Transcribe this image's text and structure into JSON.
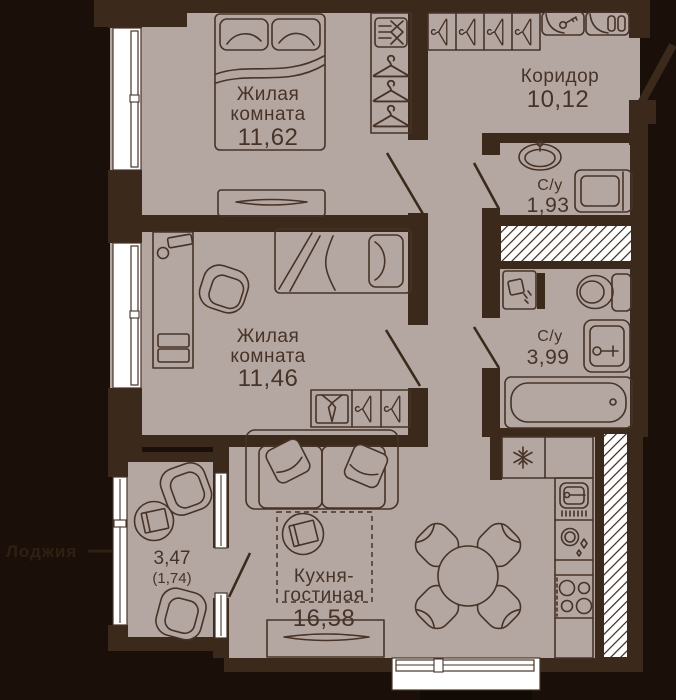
{
  "title": "Apartment floor plan",
  "colors": {
    "background": "#1a1009",
    "wall": "#3b2a1c",
    "floor": "#b4a7a2",
    "outline": "#473327",
    "text": "#473327",
    "window_white": "#ffffff",
    "outside_label": "#2f2013"
  },
  "rooms": {
    "room1": {
      "name_line1": "Жилая",
      "name_line2": "комната",
      "area": "11,62"
    },
    "room2": {
      "name_line1": "Жилая",
      "name_line2": "комната",
      "area": "11,46"
    },
    "corridor": {
      "name": "Коридор",
      "area": "10,12"
    },
    "bathroom1": {
      "name": "С/у",
      "area": "1,93"
    },
    "bathroom2": {
      "name": "С/у",
      "area": "3,99"
    },
    "kitchen_living": {
      "name_line1": "Кухня-",
      "name_line2": "гостиная",
      "area": "16,58"
    },
    "loggia": {
      "area": "3,47",
      "area_coeff": "(1,74)",
      "callout": "Лоджия"
    }
  },
  "icons": [
    "double-bed-icon",
    "pillow-icon",
    "wardrobe-hanger-icon",
    "clothes-box-icon",
    "dresser-icon",
    "desk-icon",
    "office-chair-icon",
    "single-bed-icon",
    "shirt-tie-icon",
    "sofa-icon",
    "coffee-table-icon",
    "tv-stand-icon",
    "dining-table-icon",
    "dining-chair-icon",
    "fridge-snowflake-icon",
    "kitchen-sink-icon",
    "dishwashing-icon",
    "stove-burners-icon",
    "water-heater-icon",
    "toilet-icon",
    "washbasin-icon",
    "bathtub-icon",
    "washing-machine-icon",
    "sink-oval-icon",
    "key-cabinet-icon",
    "shoe-cabinet-icon",
    "armchair-icon",
    "vent-shaft-hatch"
  ]
}
